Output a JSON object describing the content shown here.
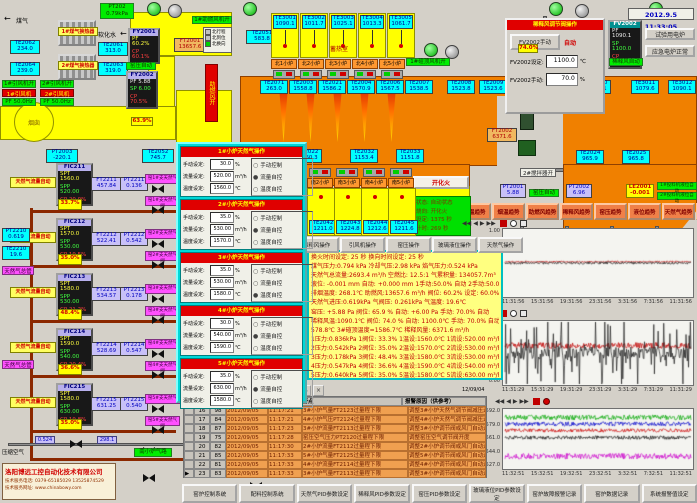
{
  "datetime": "2012.9.5 11:33:05",
  "colors": {
    "furnace": "#f08000",
    "regen": "#ffff00",
    "alarm_row": "#f0a050",
    "accent_green": "#00ee00",
    "accent_red": "#e00000"
  },
  "top_left": {
    "gas": "煤气",
    "water": "软化水",
    "pt202": {
      "t": "PT202",
      "v": "0.79kPa"
    },
    "ex1": "1#煤气换热器",
    "ex2": "2#煤气换热器",
    "te": [
      {
        "t": "TE2062",
        "v": "234.0"
      },
      {
        "t": "TE2061",
        "v": "313.0"
      },
      {
        "t": "TE2064",
        "v": "239.0"
      },
      {
        "t": "TE2063",
        "v": "319.0"
      }
    ],
    "fan1_on": "1#引风机开",
    "fan2_on": "2#引风机开",
    "fan1": "1#引风机",
    "fan2": "2#引风机",
    "pf1": "PF 50.0Hz",
    "pf2": "PF 50.0Hz",
    "fy2001": {
      "t": "FY2001",
      "r1": "PF 60.2%",
      "r2": "CP 60.1%"
    },
    "ft2001": {
      "t": "FT2001",
      "v": "13657.6"
    },
    "yaya_auto": "窑压自动",
    "fy2002": {
      "t": "FY2002",
      "r1": "PF 5.88",
      "r2": "SP 6.00",
      "r3": "CP 70.5%"
    },
    "blower_on": "1#助燃风机开",
    "legend": [
      {
        "l": "北行程"
      },
      {
        "l": "北到位"
      },
      {
        "l": "北换向"
      }
    ],
    "airbar": "助燃风开",
    "chimney": "烟囱",
    "damper": "63.9%",
    "pt2003": {
      "t": "PT2003",
      "v": "-220.1"
    },
    "te2052": {
      "t": "TE2052",
      "v": "745.7"
    },
    "te2051": {
      "t": "TE2051",
      "v": "583.8"
    }
  },
  "regen": {
    "label": "蓄热室",
    "cells": [
      {
        "t": "TE3001",
        "v": "1090.1"
      },
      {
        "t": "TE3002",
        "v": "1011.7"
      },
      {
        "t": "TE3003",
        "v": "1025.1"
      },
      {
        "t": "TE3004",
        "v": "1013.3"
      },
      {
        "t": "TE3005",
        "v": "1061.7"
      }
    ],
    "burners": [
      {
        "label": "北1小炉"
      },
      {
        "label": "北2小炉"
      },
      {
        "label": "北3小炉"
      },
      {
        "label": "北4小炉"
      },
      {
        "label": "北5小炉"
      }
    ]
  },
  "south": {
    "label": "蓄热室",
    "items": [
      {
        "label": "南1小炉",
        "t": "TE2041",
        "v": "1209.6"
      },
      {
        "label": "南2小炉",
        "t": "TE2042",
        "v": "1211.0"
      },
      {
        "label": "南3小炉",
        "t": "TE2043",
        "v": "1224.8"
      },
      {
        "label": "南4小炉",
        "t": "TE2044",
        "v": "1212.6"
      },
      {
        "label": "南5小炉",
        "t": "TE2045",
        "v": "1211.6"
      }
    ]
  },
  "furnace": {
    "te_boxes": [
      {
        "t": "TE2071",
        "v": "263.0"
      },
      {
        "t": "TE2003",
        "v": "1558.8"
      },
      {
        "t": "TE2021",
        "v": "1586.2"
      },
      {
        "t": "TE2004",
        "v": "1570.9"
      },
      {
        "t": "TE2006",
        "v": "1567.5"
      },
      {
        "t": "TE2007",
        "v": "1538.5"
      },
      {
        "t": "TE2008",
        "v": "1523.8"
      },
      {
        "t": "TE2009",
        "v": "1523.6"
      },
      {
        "t": "TE3010",
        "v": "1089.1"
      },
      {
        "t": "TE3011",
        "v": "1079.6"
      },
      {
        "t": "TE3012",
        "v": "1090.1"
      },
      {
        "t": "TE2022",
        "v": "1160.3"
      },
      {
        "t": "TE2032",
        "v": "1153.4"
      },
      {
        "t": "TE2033",
        "v": "1151.8"
      },
      {
        "t": "TE2024",
        "v": "965.9"
      },
      {
        "t": "TE2025",
        "v": "965.8"
      }
    ]
  },
  "right_top": {
    "vault_fan": "1#碹顶风机开",
    "dilute_fan": "2#稀释风机开",
    "stir1": "1#搅拌器开",
    "stir2": "2#搅拌器开",
    "auto": "稀释风自动",
    "pct": "74.0%",
    "ft2002": {
      "t": "FT2002",
      "v": "6371.6"
    },
    "btn_test": "试验用电炉",
    "btn_emerg": "应急电炉正常",
    "popup": {
      "title": "稀释风调节阀操作",
      "btn": "FV2002手动",
      "auto": "自动",
      "set": "FV2002设定:",
      "set_v": "1100.0",
      "unit_c": "℃",
      "man": "FV2002手动:",
      "man_v": "70.0",
      "unit_p": "%"
    },
    "fv": {
      "t": "FV2002",
      "r1": "PF 1090.1",
      "r2": "SP 1100.0",
      "r3": "CP 70.0%"
    }
  },
  "kiln_row": {
    "pt2001": {
      "t": "PT2001",
      "v": "5.88"
    },
    "auto": "窑压自动",
    "pt2002": {
      "t": "PT2002",
      "v": "6.96"
    },
    "le": {
      "t": "LE2001",
      "v": "-0.001"
    },
    "f1": "1#投料机液位自动",
    "f2": "2#投料机液位自动"
  },
  "trend_buttons": [
    {
      "label": "窑温趋势"
    },
    {
      "label": "烟温趋势"
    },
    {
      "label": "助燃风趋势"
    },
    {
      "label": "稀释风趋势"
    },
    {
      "label": "窑压趋势"
    },
    {
      "label": "液位趋势"
    },
    {
      "label": "天然气趋势"
    },
    {
      "label": "冷却气趋势"
    }
  ],
  "gas_popup": {
    "labels": {
      "man": "手动设定:",
      "flow": "流量设定:",
      "temp": "温度设定:",
      "u_man": "%",
      "u_flow": "m³/h",
      "u_temp": "℃",
      "r1": "手动控制",
      "r2": "流量自控",
      "r3": "温度自控"
    },
    "sections": [
      {
        "title": "1#小炉天然气操作",
        "man": "30.0",
        "flow": "520.00",
        "temp": "1560.0",
        "d1": "○",
        "d2": "●",
        "d3": "○"
      },
      {
        "title": "2#小炉天然气操作",
        "man": "35.0",
        "flow": "530.00",
        "temp": "1570.0",
        "d1": "○",
        "d2": "●",
        "d3": "○"
      },
      {
        "title": "3#小炉天然气操作",
        "man": "35.0",
        "flow": "530.00",
        "temp": "1580.0",
        "d1": "○",
        "d2": "○",
        "d3": "●"
      },
      {
        "title": "4#小炉天然气操作",
        "man": "30.0",
        "flow": "540.00",
        "temp": "1590.0",
        "d1": "○",
        "d2": "●",
        "d3": "○"
      },
      {
        "title": "5#小炉天然气操作",
        "man": "35.0",
        "flow": "630.00",
        "temp": "1580.0",
        "d1": "○",
        "d2": "●",
        "d3": "○"
      }
    ]
  },
  "manifold": {
    "pt": {
      "t": "PT2210",
      "v": "0.619"
    },
    "te": {
      "t": "TE2210",
      "v": "19.6"
    },
    "main1": "天然气总管",
    "main2": "天然气总管",
    "rows": [
      {
        "auto": "天然气流量自动",
        "fic": "FIC211",
        "spt": "SPT 1560.0",
        "spp": "SPP 520.00",
        "cp": "CP 20.0%",
        "ft_t": "FT2211",
        "ft_v": "457.84",
        "pt_t": "PT2211",
        "pt_v": "0.136",
        "pct": "33.7%",
        "branch": "窑1#支天然气",
        "valve": "窑1#支天然气阀"
      },
      {
        "auto": "天然气流量自动",
        "fic": "FIC212",
        "spt": "SPT 1570.0",
        "spp": "SPP 530.00",
        "cp": "CP 19.5%",
        "ft_t": "FT2212",
        "ft_v": "522.41",
        "pt_t": "PT2212",
        "pt_v": "0.542",
        "pct": "35.0%",
        "branch": "窑2#支天然气",
        "valve": "窑2#支天然气阀"
      },
      {
        "auto": "天然气流量自动",
        "fic": "FIC213",
        "spt": "SPT 1580.0",
        "spp": "SPP 530.00",
        "cp": "CP 21.2%",
        "ft_t": "FT2213",
        "ft_v": "534.57",
        "pt_t": "PT2213",
        "pt_v": "0.178",
        "pct": "48.4%",
        "branch": "窑3#支天然气",
        "valve": "窑3#支天然气阀"
      },
      {
        "auto": "天然气流量自动",
        "fic": "FIC214",
        "spt": "SPT 1590.0",
        "spp": "SPP 540.00",
        "cp": "CP 20.4%",
        "ft_t": "FT2214",
        "ft_v": "528.69",
        "pt_t": "PT2214",
        "pt_v": "0.547",
        "pct": "36.6%",
        "branch": "窑4#支天然气",
        "valve": "窑4#支天然气阀"
      },
      {
        "auto": "天然气流量自动",
        "fic": "FIC215",
        "spt": "SPT 1580.0",
        "spp": "SPP 630.00",
        "cp": "CP 19.8%",
        "ft_t": "FT2215",
        "ft_v": "631.25",
        "pt_t": "PT2215",
        "pt_v": "0.540",
        "pct": "35.0%",
        "branch": "窑5#支天然气",
        "valve": "窑5#支天然气阀"
      }
    ],
    "air": {
      "label": "压缩空气",
      "v1": "0.524",
      "v2": "298.1",
      "green": "南小炉气路"
    }
  },
  "huohua": {
    "btn": "开化火",
    "rows": [
      {
        "txt": "状态: 自动状态"
      },
      {
        "txt": "烧向: 开化火"
      },
      {
        "txt": "设定:  1375 秒"
      },
      {
        "txt": "计时:   269 秒"
      }
    ]
  },
  "op_buttons": [
    {
      "label": "助燃风操作"
    },
    {
      "label": "稀释风操作"
    },
    {
      "label": "引风机操作"
    },
    {
      "label": "窑压操作"
    },
    {
      "label": "玻璃液位操作"
    },
    {
      "label": "天然气操作"
    }
  ],
  "info_rows": [
    {
      "txt": "换火时间设定:  25 秒    换向时间设定:  25 秒"
    },
    {
      "txt": "煤气压力:0.794 kPa  冷却气压:2.98 kPa  焰气压力:0.524 kPa"
    },
    {
      "txt": "天然气总流量:2693.4 m³/h  空燃比: 12.5:1  气累积量: 134057.7m³"
    },
    {
      "txt": "液位: -0.001 mm  自动: +0.000 mm  1手动:50.0% 自动  2手动:50.0% 自动"
    },
    {
      "txt": "排烟温度: 268.1℃  助燃风:13657.6 m³/h  阀位: 60.2%  设定: 60.0%"
    },
    {
      "txt": "天然气进压:0.619kPa  气阀压: 0.261kPa  气温度: 19.6℃"
    },
    {
      "txt": "窑压: +5.88 Pa  阀位: 65.9 %  自动: +6.00 Pa  手动: 70.0%  自动"
    },
    {
      "txt": "稀释风温:1090.1℃  阀位: 74.0 %  自动: 1100.0℃  手动: 70.0%  自动"
    },
    {
      "txt": "578.8℃  3#碹顶温度=1586.7℃  稀释风量: 6371.6 m³/h"
    },
    {
      "txt": "1压力:0.836kPa 1阀位: 33.3%  1温设:1560.0℃ 1流设:520.00 m³/h 1手动:30.0% 流控"
    },
    {
      "txt": "2压力:0.542kPa 2阀位: 35.0%  2温设:1570.0℃ 2流设:530.00 m³/h 2手动:35.0% 流控"
    },
    {
      "txt": "3压力:0.178kPa 3阀位: 48.4%  3温设:1580.0℃ 3流设:530.00 m³/h 3手动:35.0% 温控"
    },
    {
      "txt": "4压力:0.547kPa 4阀位: 36.6%  4温设:1590.0℃ 4流设:540.00 m³/h 4手动:30.0% 流控"
    },
    {
      "txt": "5压力:0.640kPa 5阀位: 35.0%  5温设:1580.0℃ 5流设:630.00 m³/h 5手动:35.0% 流控"
    }
  ],
  "alarm": {
    "h_point": "报警点",
    "h_reason": "报警原因（供参考）",
    "rows": [
      {
        "sel": "",
        "no": "16",
        "code": "98",
        "date": "2012/09/05",
        "time": "11:17:21",
        "point": "3#小炉气量FT2123过量程下限",
        "reason": "调整3#小炉天然气调节阀减压过渡"
      },
      {
        "sel": "",
        "no": "17",
        "code": "84",
        "date": "2012/09/05",
        "time": "11:17:21",
        "point": "4#小炉气压PT2124过量程下限",
        "reason": "调整4#小炉天然气调节阀减压过渡"
      },
      {
        "sel": "",
        "no": "18",
        "code": "87",
        "date": "2012/09/05",
        "time": "11:17:23",
        "point": "3#小炉流量FT2113过量程下限",
        "reason": "调整3#小炉调节阀或风门自动运行"
      },
      {
        "sel": "",
        "no": "19",
        "code": "75",
        "date": "2012/09/05",
        "time": "11:17:28",
        "point": "窑压空气压力PT2120过量程下限",
        "reason": "调整窑压空气调节阀开度"
      },
      {
        "sel": "",
        "no": "20",
        "code": "82",
        "date": "2012/09/05",
        "time": "11:17:30",
        "point": "2#小炉流量FT2112过量程下限",
        "reason": "调整2#小炉调节阀或风门自动运行"
      },
      {
        "sel": "",
        "no": "21",
        "code": "85",
        "date": "2012/09/05",
        "time": "11:17:33",
        "point": "5#小炉气量FT2125过量程下限",
        "reason": "调整5#小炉调节阀或风门自动运行"
      },
      {
        "sel": "",
        "no": "22",
        "code": "81",
        "date": "2012/09/05",
        "time": "11:17:33",
        "point": "4#小炉流量FT2114过量程下限",
        "reason": "调整4#小炉调节阀或风门自动运行"
      },
      {
        "sel": "▶",
        "no": "23",
        "code": "83",
        "date": "2012/09/05",
        "time": "11:17:33",
        "point": "3#小炉气量FT2113过量程下限",
        "reason": "调整3#小炉调节阀或风门自动运行"
      }
    ]
  },
  "charts": {
    "nav": [
      {
        "g": "◀◀"
      },
      {
        "g": "◀"
      },
      {
        "g": "▶"
      },
      {
        "g": "▶▶"
      }
    ],
    "date": "12/09/04"
  },
  "chart_data": [
    {
      "type": "line",
      "title": "玻璃液位趋势",
      "ylim": [
        -1.3,
        1.3
      ],
      "yticks": [
        {
          "v": "1.00"
        },
        {
          "v": "0.00"
        },
        {
          "v": "-1.00"
        }
      ],
      "xticks": [
        {
          "v": "11:31:56"
        },
        {
          "v": "15:31:56"
        },
        {
          "v": "19:31:56"
        },
        {
          "v": "23:31:56"
        },
        {
          "v": "3:31:56"
        },
        {
          "v": "7:31:56"
        },
        {
          "v": "11:31:56"
        }
      ],
      "date_label": "12/09/04",
      "legend_position": "none",
      "grid": false,
      "series": [
        {
          "name": "液位设定",
          "color": "#c00000",
          "base": 0.05,
          "amp": 0.03,
          "spiky": false
        },
        {
          "name": "玻璃液位",
          "color": "#202020",
          "base": 0.0,
          "amp": 0.05,
          "spiky": false
        }
      ]
    },
    {
      "type": "line",
      "title": "窑压趋势",
      "ylim": [
        0,
        12
      ],
      "yticks": [
        {
          "v": "11.00"
        },
        {
          "v": "9.00"
        },
        {
          "v": "6.00"
        },
        {
          "v": "3.00"
        },
        {
          "v": "0.00"
        }
      ],
      "xticks": [
        {
          "v": "11:31:29"
        },
        {
          "v": "15:31:29"
        },
        {
          "v": "19:31:29"
        },
        {
          "v": "23:31:29"
        },
        {
          "v": "3:31:29"
        },
        {
          "v": "7:31:29"
        },
        {
          "v": "11:31:29"
        }
      ],
      "date_label": "12/09/04",
      "legend_position": "none",
      "grid": false,
      "series": [
        {
          "name": "窑压设定",
          "color": "#c00000",
          "base": 7.5,
          "amp": 0.6,
          "spiky": false
        },
        {
          "name": "窑压实测",
          "color": "#202020",
          "base": 6.0,
          "amp": 3.4,
          "spiky": true
        }
      ]
    },
    {
      "type": "line",
      "title": "小炉温度趋势",
      "ylim": [
        1520,
        1598
      ],
      "yticks": [
        {
          "v": "1592.0"
        },
        {
          "v": "1579.0"
        },
        {
          "v": "1561.0"
        },
        {
          "v": "1544.0"
        },
        {
          "v": "1527.0"
        }
      ],
      "xticks": [
        {
          "v": "11:32:51"
        },
        {
          "v": "15:32:51"
        },
        {
          "v": "19:32:51"
        },
        {
          "v": "23:32:51"
        },
        {
          "v": "3:32:51"
        },
        {
          "v": "7:32:51"
        },
        {
          "v": "11:32:51"
        }
      ],
      "date_label": "12/09/04",
      "legend_position": "none",
      "grid": false,
      "series": [
        {
          "name": "4#小炉温度",
          "color": "#00a800",
          "base": 1589,
          "amp": 3.5,
          "spiky": false
        },
        {
          "name": "2#小炉温度",
          "color": "#0000cc",
          "base": 1580,
          "amp": 3.0,
          "spiky": false
        },
        {
          "name": "3#小炉温度",
          "color": "#cc0000",
          "base": 1571,
          "amp": 2.5,
          "spiky": false
        },
        {
          "name": "1#小炉温度",
          "color": "#101010",
          "base": 1561,
          "amp": 2.5,
          "spiky": false
        },
        {
          "name": "5#小炉温度",
          "color": "#cc00cc",
          "base": 1535,
          "amp": 4.0,
          "spiky": false
        }
      ]
    }
  ],
  "bottom_buttons": [
    {
      "label": "窑炉控制系统"
    },
    {
      "label": "配料控制系统"
    },
    {
      "label": "天然气PID参数设定"
    },
    {
      "label": "稀释风PID参数设定"
    },
    {
      "label": "窑压PID参数设定"
    },
    {
      "label": "玻璃液位PID参数设定"
    },
    {
      "label": "窑炉故障报警记录"
    },
    {
      "label": "窑炉数据记录"
    },
    {
      "label": "系统报警值设定"
    }
  ],
  "company": {
    "name": "洛阳博远工控自动化技术有限公司",
    "tel": "技术服务电话: 0379-65185029  13525874529",
    "web": "技术服务网址: www.chinabowy.com"
  }
}
